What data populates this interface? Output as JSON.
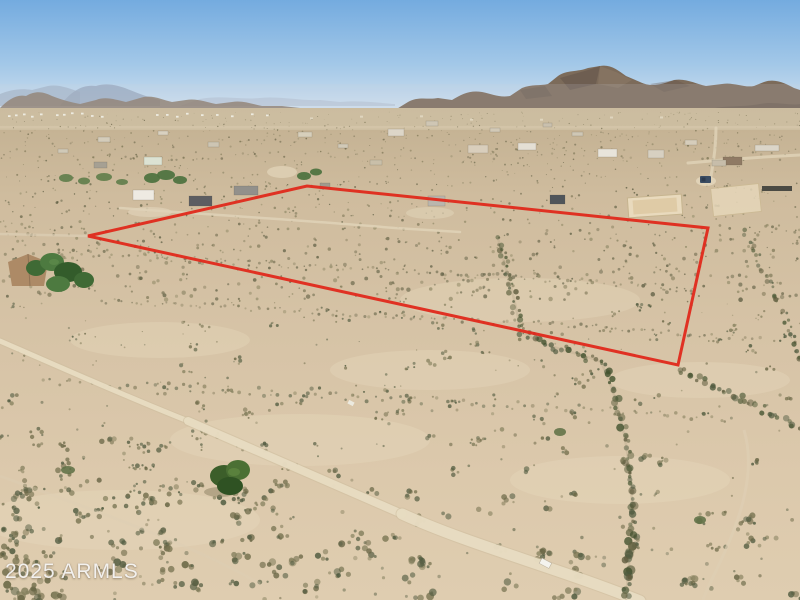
{
  "scene": {
    "watermark": "2025 ARMLS"
  },
  "boundary": {
    "color": "#e02b1d",
    "points": "88,236 307,186 708,228 678,365",
    "stroke_width": "3"
  },
  "palette": {
    "sky_top": "#74abdf",
    "sky_horizon": "#d8e4ee",
    "mountain": "#7c6b5a",
    "mountain_shadow": "#5a4d42",
    "mountain_haze": "#93a3b8",
    "sand_far": "#c2b091",
    "sand_near": "#dfcdb0",
    "road": "#e7dbc1",
    "scrub_far": [
      "#8a8166",
      "#76704f",
      "#9c9272",
      "#6d684c"
    ],
    "scrub_mid": [
      "#6f6b4f",
      "#837c5c",
      "#5f5f44",
      "#918a68"
    ],
    "scrub_near": [
      "#6b6847",
      "#7a7553",
      "#575f44",
      "#86815f",
      "#4f5a3f"
    ],
    "wash_veg": [
      "#4f5a3f",
      "#5d5a3c",
      "#6a6b4a",
      "#43522f"
    ],
    "tree_green": [
      "#3f6a35",
      "#4d7a40",
      "#335c2b"
    ]
  }
}
